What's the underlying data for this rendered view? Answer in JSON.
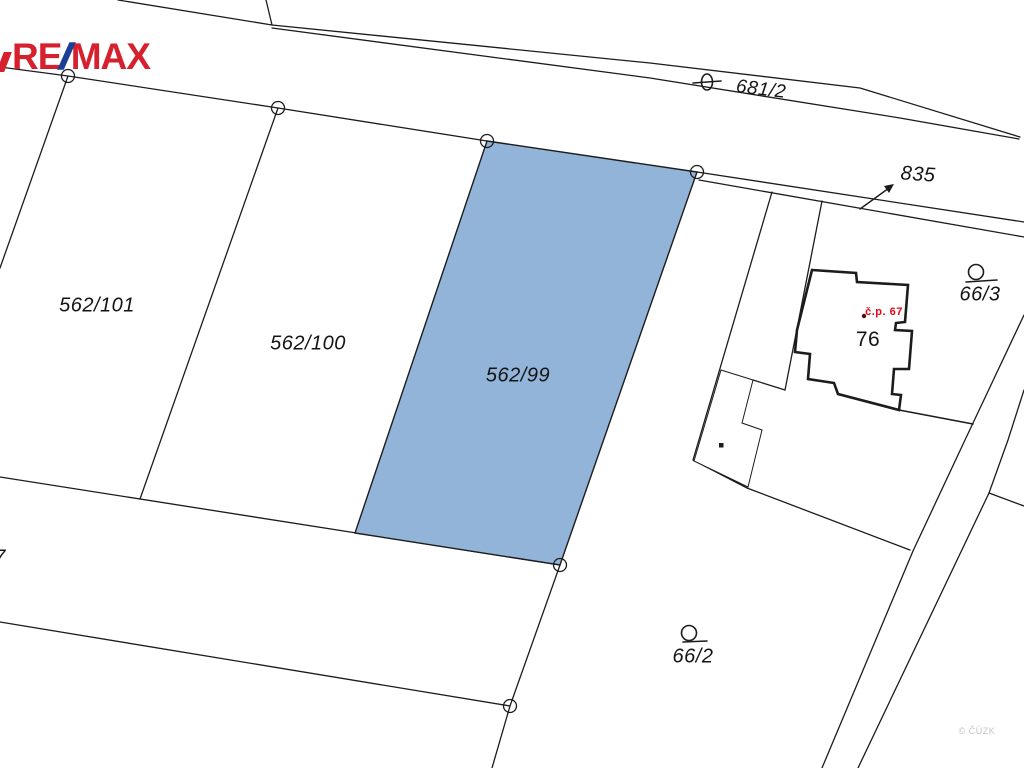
{
  "brand": {
    "re": "RE",
    "slash": "/",
    "max": "MAX",
    "red": "#d6202e",
    "blue": "#1c3e94"
  },
  "map": {
    "background": "#ffffff",
    "line_color": "#1c1c1c",
    "highlight_fill": "#92b4d8",
    "labels": [
      {
        "id": "parcel-562-101",
        "text": "562/101",
        "x": 97,
        "y": 306,
        "size": 20,
        "italic": true
      },
      {
        "id": "parcel-562-100",
        "text": "562/100",
        "x": 308,
        "y": 344,
        "size": 20,
        "italic": true
      },
      {
        "id": "parcel-562-99",
        "text": "562/99",
        "x": 518,
        "y": 376,
        "size": 20,
        "italic": true
      },
      {
        "id": "parcel-681-2",
        "text": "681/2",
        "x": 761,
        "y": 90,
        "size": 19,
        "italic": true,
        "rotate": 7
      },
      {
        "id": "parcel-835",
        "text": "835",
        "x": 918,
        "y": 175,
        "size": 20,
        "italic": true,
        "rotate": 4
      },
      {
        "id": "parcel-66-3",
        "text": "66/3",
        "x": 980,
        "y": 295,
        "size": 20,
        "italic": true
      },
      {
        "id": "parcel-66-2",
        "text": "66/2",
        "x": 693,
        "y": 657,
        "size": 20,
        "italic": true
      },
      {
        "id": "building-76",
        "text": "76",
        "x": 868,
        "y": 340,
        "size": 21,
        "italic": false
      },
      {
        "id": "parcel-7-clipped",
        "text": "7",
        "x": 0,
        "y": 558,
        "size": 20,
        "italic": true
      },
      {
        "id": "house-number",
        "text": "č.p. 67",
        "x": 884,
        "y": 312,
        "size": 11,
        "italic": false,
        "bold": true,
        "color": "#e30613"
      },
      {
        "id": "watermark",
        "text": "© ČÚZK",
        "x": 977,
        "y": 731,
        "size": 9,
        "italic": false,
        "color": "#c4c4c4"
      }
    ]
  }
}
